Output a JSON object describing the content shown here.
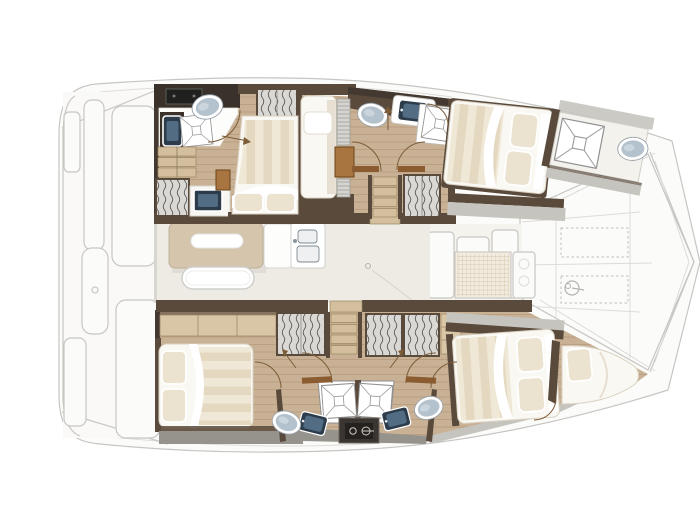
{
  "meta": {
    "title": "Catamaran interior layout plan — deck plan, bow to the right",
    "type": "yacht floor plan diagram"
  },
  "palette": {
    "wood": "#c8b194",
    "woodStripe": "#b79d7e",
    "woodLight": "#d9c6a6",
    "woodStep": "#d3bf9d",
    "wall": "#594a3c",
    "wallDark": "#433931",
    "counterDark": "#39312a",
    "saloonFloor": "#edebe4",
    "fadedStroke": "#c7c6c3",
    "fadedFill": "#fbfbf9",
    "mattress": "#faf8f2",
    "stripeA": "#efe7d5",
    "stripeB": "#e3d6bd",
    "pillow": "#ebe2cf",
    "locker": "#d9d8d5",
    "toilet": "#b4c2ce",
    "sink": "#2d3c4b",
    "sinkInner": "#55718a",
    "grayDeck": "#c6c4bf",
    "grayDark": "#96938c",
    "table": "#d4c5ac",
    "doorArc": "#7d5c38",
    "doorLeaf": "#8a5c30",
    "darkUnit": "#3b3531",
    "glyph": "#cfcac2"
  },
  "legend": {
    "saloon": {
      "label": "saloon and galley",
      "fixtures": [
        "dining table",
        "bench seat",
        "galley counter",
        "double sink",
        "refrigerator"
      ]
    },
    "upper_hull": {
      "label": "upper hull",
      "rooms": [
        "aft cabin with double bed",
        "en-suite head with toilet, washbasin and shower",
        "single berth",
        "forward cabin with double bed",
        "en-suite head with toilet, washbasin and shower",
        "bow head with shower grate and toilet"
      ]
    },
    "lower_hull": {
      "label": "lower hull",
      "rooms": [
        "aft cabin with double bed",
        "aft head with toilet, washbasin and shower",
        "forward head with toilet, washbasin and shower",
        "forward cabin with double bed",
        "bow berth"
      ]
    },
    "exterior": {
      "label": "exterior shown faded",
      "areas": [
        "aft cockpit with bench seating",
        "forward cockpit with deck mat",
        "foredeck panels with hatches and windlass",
        "bowsprit lines"
      ]
    }
  },
  "fixture_counts": {
    "double_beds": 4,
    "single_berths": 1,
    "bow_berths": 1,
    "toilets": 5,
    "showers": 5,
    "washbasins": 4,
    "galley_sinks": 1,
    "wardrobes": 6,
    "stair_flights": 3,
    "dining_tables": 1,
    "bench_seats": 1,
    "deck_hatches": 2
  },
  "icons": {
    "windlass": "circle with line",
    "shower": "square with X grate",
    "wardrobe": "vertical wavy hanger lines",
    "power_panel": "plug glyph in dark box"
  }
}
